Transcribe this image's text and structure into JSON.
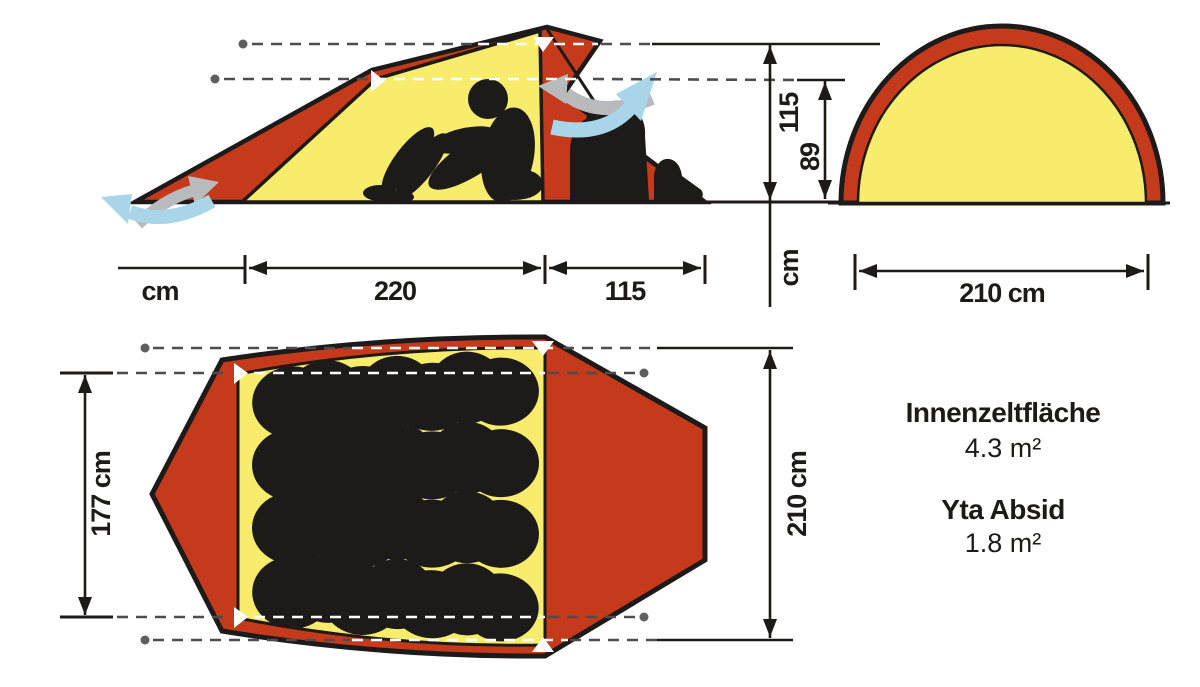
{
  "diagram": {
    "side_view": {
      "peak_height": "115",
      "inner_height": "89",
      "height_unit": "cm",
      "inner_length": "220",
      "vestibule_length": "115",
      "length_unit": "cm"
    },
    "front_view": {
      "width_label": "210 cm"
    },
    "top_view": {
      "inner_width_label": "177 cm",
      "outer_width_label": "210 cm"
    },
    "specs": {
      "inner_area_title": "Innenzeltfläche",
      "inner_area_value": "4.3 m²",
      "vestibule_area_title": "Yta Absid",
      "vestibule_area_value": "1.8 m²"
    },
    "colors": {
      "fly_red": "#c63a1c",
      "inner_yellow": "#f7ec6b",
      "silhouette_black": "#1d1b19",
      "airflow_blue": "#a8d6e8",
      "airflow_gray": "#b7bbbd",
      "dash_gray": "#4d4d4d"
    }
  }
}
